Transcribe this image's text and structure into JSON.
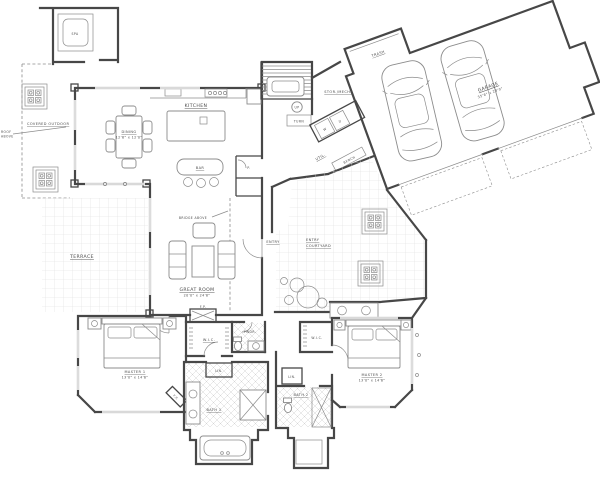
{
  "colors": {
    "bg": "#ffffff",
    "wall": "#474747",
    "line": "#8c8c8c",
    "grid": "#dedede",
    "hatch": "#d4d4d4",
    "text": "#4a4a4a"
  },
  "labels": {
    "spa": "SPA",
    "covered_outdoor": "COVERED OUTDOOR",
    "note_line1": "ROOF",
    "note_line2": "ABOVE",
    "terrace": "TERRACE",
    "kitchen": "KITCHEN",
    "dining": "DINING",
    "dining_dims": "12'6\" x 12'0\"",
    "bar": "BAR",
    "pantry": "P.",
    "great_room": "GREAT ROOM",
    "great_room_dims": "20'0\" x 24'8\"",
    "bridge_above": "BRIDGE ABOVE",
    "stor_mech": "STOR./MECH.",
    "up": "UP",
    "turn": "TURN",
    "util": "UTIL.",
    "bench": "BENCH",
    "washer": "W",
    "dryer": "D",
    "trash": "TRASH",
    "garage": "GARAGE",
    "garage_dims": "35'8\" x 23'0\"",
    "entry": "ENTRY",
    "entry_courtyard_line1": "ENTRY",
    "entry_courtyard_line2": "COURTYARD",
    "master1": "MASTER 1",
    "master1_dims": "13'0\" x 14'6\"",
    "master2": "MASTER 2",
    "master2_dims": "13'0\" x 14'6\"",
    "wic1": "W.I.C.",
    "wic2": "W.I.C.",
    "pwdr": "PWDR.",
    "bath1": "BATH 1",
    "bath2": "BATH 2",
    "lin1": "LIN.",
    "lin2": "LIN.",
    "fp1": "F.P.",
    "fp2": "F.P."
  }
}
